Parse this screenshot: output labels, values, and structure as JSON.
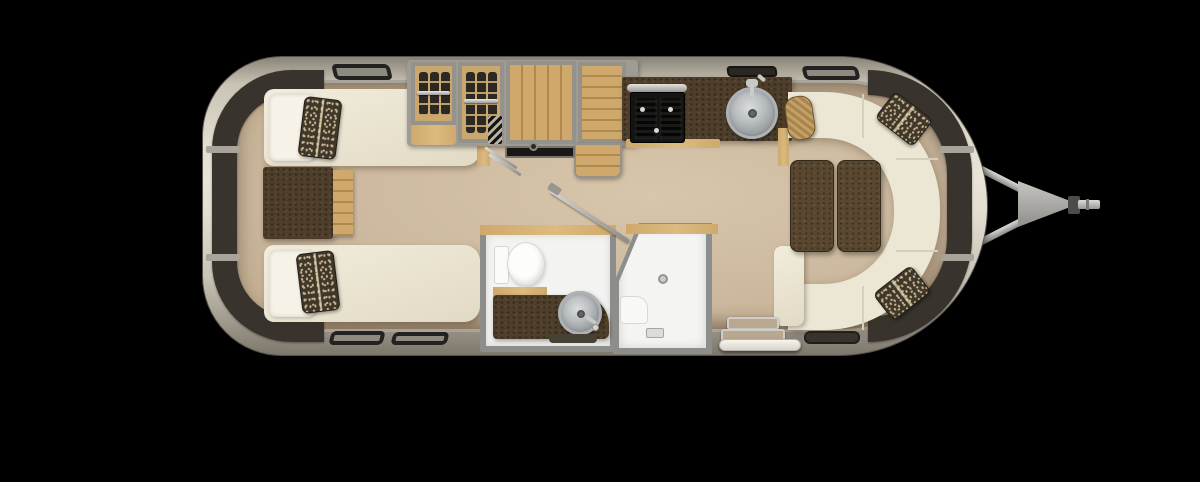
{
  "meta": {
    "title": "Travel trailer floor plan — overhead view"
  },
  "colors": {
    "bg": "#000000",
    "shell_hi": "#e3ded1",
    "shell_mid": "#c9c3b6",
    "shell_lo": "#8a8478",
    "shell_edge": "#55524b",
    "wall": "#a9a49a",
    "window": "#38342d",
    "floor_hi": "#d8c6ab",
    "floor_mid": "#cdbaa0",
    "floor_lo": "#bfab8f",
    "cream": "#ece6d5",
    "cream_hi": "#f2ecdc",
    "cream_lo": "#e1dac5",
    "seam": "#d6cfba",
    "white": "#f3f3f1",
    "bath_wall": "#8d8d8b",
    "wood": "#cfa96c",
    "wood_dark": "#b1894e",
    "wood_hi": "#dcba80",
    "brown": "#4e3e2a",
    "brown_hi": "#5a4730",
    "brown_edge": "#33291a",
    "speck_base": "#3e372c",
    "speck_dot": "#cdb58b",
    "steel_hi": "#dddcd8",
    "steel_lo": "#8a8985",
    "frame": "#95928c"
  },
  "labels": {
    "trailer": "Travel trailer body (overhead floor plan)",
    "interior": "Interior floor",
    "window_rear": "Rear wraparound window",
    "window_front": "Front wraparound window",
    "roof_vent": "Roof vent",
    "bedroom": "Rear twin bedroom",
    "bed_upper": "Twin bed (upper)",
    "bed_lower": "Twin bed (lower)",
    "pillow": "Pillow",
    "accent_pillow": "Accent pillow",
    "nightstand": "Nightstand",
    "wardrobe": "Wardrobe closets",
    "closet": "Hanging closet",
    "cabinet": "Storage cabinet",
    "fridge": "Refrigerator cabinet",
    "ladder": "Step ladder",
    "tv": "TV on sliding rail",
    "kitchen": "Galley kitchen counter",
    "stove": "Two-burner cooktop",
    "kitchen_sink": "Round kitchen sink",
    "range_vent": "Range vent",
    "bathroom": "Toilet and vanity room",
    "toilet": "Toilet",
    "vanity": "Vanity with round sink",
    "bath_mat": "Bath mat",
    "shower": "Shower stall",
    "shower_door": "Shower door (open)",
    "lounge": "Front wraparound lounge",
    "sofa": "Wraparound sofa",
    "table_left": "Table leaf (left)",
    "table_right": "Table leaf (right)",
    "bolster": "Bolster pillow",
    "entry": "Entry step well",
    "step": "Exterior entry step",
    "hitch": "Tow hitch and coupler"
  }
}
